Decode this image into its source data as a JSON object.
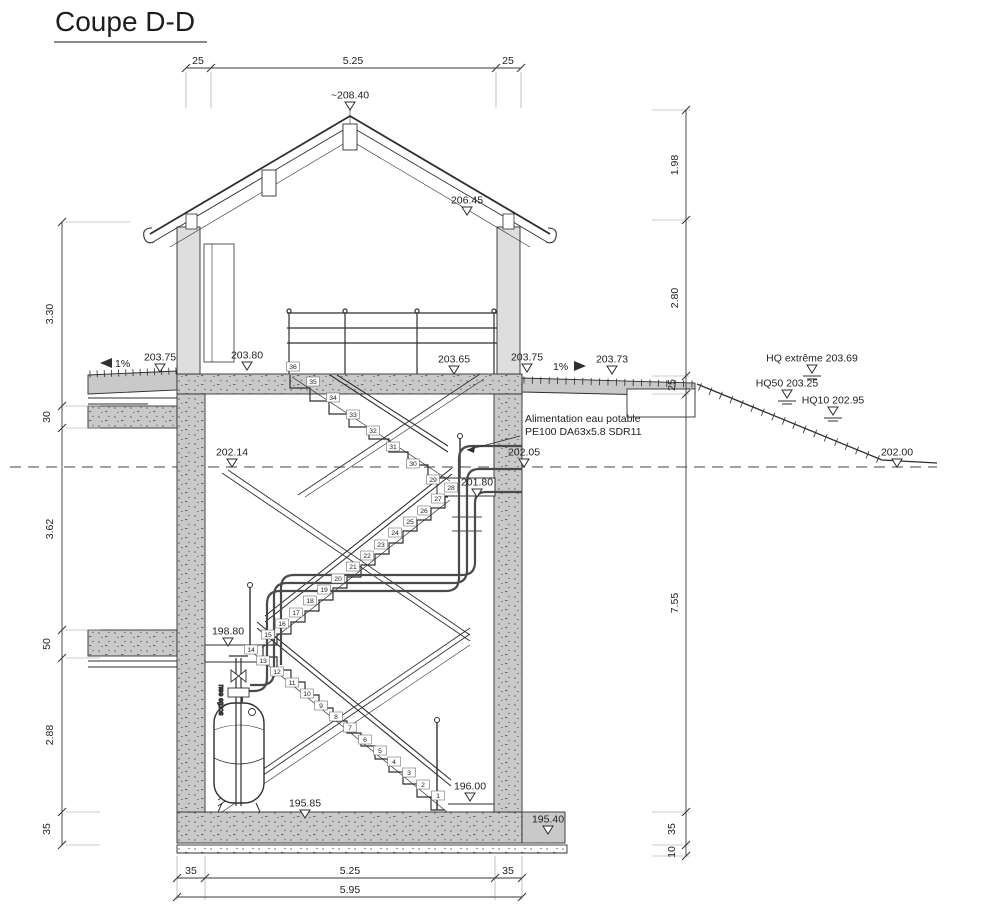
{
  "title": {
    "text": "Coupe D-D"
  },
  "note": {
    "line1": "Alimentation eau potable",
    "line2": "PE100 DA63x5.8 SDR11"
  },
  "pump": {
    "vertical_label": "sortie eau"
  },
  "slopes": {
    "left": "1%",
    "right": "1%"
  },
  "dims": {
    "top": [
      "25",
      "5.25",
      "25"
    ],
    "left": [
      "3.30",
      "30",
      "3.62",
      "50",
      "2.88",
      "35"
    ],
    "right": [
      "1.98",
      "2.80",
      "25",
      "7.55",
      "35",
      "10"
    ],
    "bottom": [
      "35",
      "5.25",
      "35"
    ],
    "bottom_total": "5.95"
  },
  "markers": [
    {
      "label": "~208.40",
      "x": 350,
      "y": 102,
      "water": false
    },
    {
      "label": "206.45",
      "x": 467,
      "y": 207,
      "water": false
    },
    {
      "label": "203.75",
      "x": 160,
      "y": 364,
      "water": false
    },
    {
      "label": "203.80",
      "x": 247,
      "y": 362,
      "water": false
    },
    {
      "label": "203.65",
      "x": 454,
      "y": 366,
      "water": false
    },
    {
      "label": "203.75",
      "x": 527,
      "y": 364,
      "water": false
    },
    {
      "label": "203.73",
      "x": 612,
      "y": 366,
      "water": false
    },
    {
      "label": "HQ extrême 203.69",
      "x": 812,
      "y": 365,
      "water": true
    },
    {
      "label": "HQ50 203.25",
      "x": 787,
      "y": 390,
      "water": true
    },
    {
      "label": "HQ10 202.95",
      "x": 833,
      "y": 407,
      "water": true
    },
    {
      "label": "202.14",
      "x": 232,
      "y": 459,
      "water": false
    },
    {
      "label": "202.05",
      "x": 524,
      "y": 459,
      "water": false
    },
    {
      "label": "202.00",
      "x": 897,
      "y": 459,
      "water": false
    },
    {
      "label": "201.80",
      "x": 477,
      "y": 489,
      "water": false
    },
    {
      "label": "198.80",
      "x": 228,
      "y": 638,
      "water": false
    },
    {
      "label": "195.85",
      "x": 305,
      "y": 810,
      "water": false
    },
    {
      "label": "196.00",
      "x": 470,
      "y": 793,
      "water": false
    },
    {
      "label": "195.40",
      "x": 548,
      "y": 826,
      "water": false
    }
  ],
  "steps": [
    {
      "n": "1",
      "x": 438,
      "y": 798
    },
    {
      "n": "2",
      "x": 423,
      "y": 787
    },
    {
      "n": "3",
      "x": 409,
      "y": 775
    },
    {
      "n": "4",
      "x": 394,
      "y": 764
    },
    {
      "n": "5",
      "x": 380,
      "y": 753
    },
    {
      "n": "6",
      "x": 365,
      "y": 742
    },
    {
      "n": "7",
      "x": 350,
      "y": 730
    },
    {
      "n": "8",
      "x": 336,
      "y": 719
    },
    {
      "n": "9",
      "x": 321,
      "y": 708
    },
    {
      "n": "10",
      "x": 307,
      "y": 696
    },
    {
      "n": "11",
      "x": 292,
      "y": 685
    },
    {
      "n": "12",
      "x": 277,
      "y": 674
    },
    {
      "n": "13",
      "x": 263,
      "y": 663
    },
    {
      "n": "14",
      "x": 251,
      "y": 652
    },
    {
      "n": "15",
      "x": 268,
      "y": 637
    },
    {
      "n": "16",
      "x": 282,
      "y": 626
    },
    {
      "n": "17",
      "x": 296,
      "y": 615
    },
    {
      "n": "18",
      "x": 310,
      "y": 603
    },
    {
      "n": "19",
      "x": 324,
      "y": 592
    },
    {
      "n": "20",
      "x": 338,
      "y": 581
    },
    {
      "n": "21",
      "x": 353,
      "y": 569
    },
    {
      "n": "22",
      "x": 367,
      "y": 558
    },
    {
      "n": "23",
      "x": 381,
      "y": 547
    },
    {
      "n": "24",
      "x": 395,
      "y": 535
    },
    {
      "n": "25",
      "x": 410,
      "y": 524
    },
    {
      "n": "26",
      "x": 424,
      "y": 513
    },
    {
      "n": "27",
      "x": 438,
      "y": 501
    },
    {
      "n": "28",
      "x": 451,
      "y": 490
    },
    {
      "n": "29",
      "x": 433,
      "y": 482
    },
    {
      "n": "30",
      "x": 413,
      "y": 466
    },
    {
      "n": "31",
      "x": 393,
      "y": 449
    },
    {
      "n": "32",
      "x": 373,
      "y": 433
    },
    {
      "n": "33",
      "x": 353,
      "y": 417
    },
    {
      "n": "34",
      "x": 333,
      "y": 400
    },
    {
      "n": "35",
      "x": 313,
      "y": 384
    },
    {
      "n": "36",
      "x": 293,
      "y": 369
    }
  ],
  "colors": {
    "line": "#2f2f2f",
    "concrete": "#c9c9c9",
    "paper": "#ffffff"
  }
}
